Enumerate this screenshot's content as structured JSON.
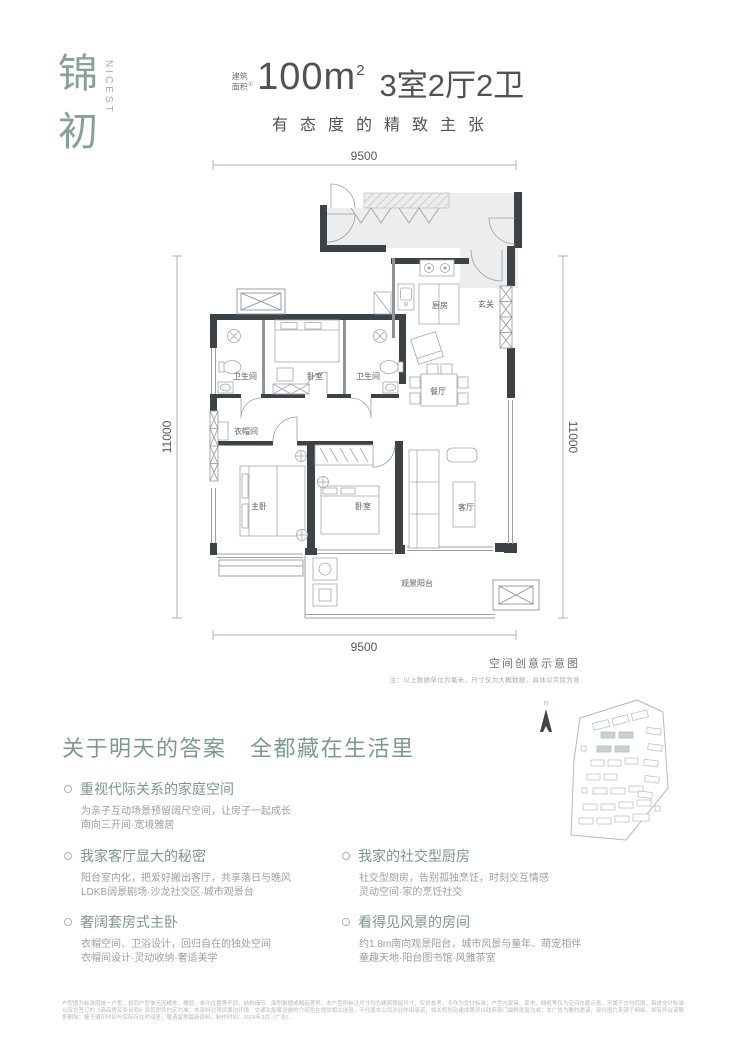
{
  "logo": {
    "char1": "锦",
    "char2": "初",
    "latin": "NICEST"
  },
  "header": {
    "area_label_top": "建筑",
    "area_label_bottom": "面积",
    "area_mark": "①",
    "area_value": "100m",
    "area_sup": "2",
    "layout_value": "3室2厅2卫",
    "slogan": "有态度的精致主张"
  },
  "floorplan": {
    "dims": {
      "top": "9500",
      "bottom": "9500",
      "left": "11000",
      "right": "11000"
    },
    "rooms": {
      "kitchen": "厨房",
      "entry": "玄关",
      "bathroom1": "卫生间",
      "bedroom_top": "卧室",
      "bathroom2": "卫生间",
      "dining": "餐厅",
      "cloakroom": "衣帽间",
      "master": "主卧",
      "bedroom2": "卧室",
      "living": "客厅",
      "balcony": "观景阳台"
    },
    "caption": "空间创意示意图",
    "note": "注：以上数据单位为毫米，尺寸仅为大概数据，具体以实际为准"
  },
  "sitemap": {
    "north_label": "N"
  },
  "section": {
    "heading": "关于明天的答案　全都藏在生活里",
    "features": [
      {
        "title": "重视代际关系的家庭空间",
        "line1": "为亲子互动场景预留阔尺空间，让房子一起成长",
        "line2": "南向三开间·宽境雅居"
      },
      {
        "title": "我家客厅显大的秘密",
        "line1": "阳台室内化，把爱好搬出客厅，共享落日与晚风",
        "line2": "LDKB阔景剧场·沙龙社交区·城市观景台"
      },
      {
        "title": "奢阔套房式主卧",
        "line1": "衣帽空间、卫浴设计，回归自在的独处空间",
        "line2": "衣帽间设计·灵动收纳·奢适美学"
      },
      {
        "title": "我家的社交型厨房",
        "line1": "社交型厨房，告别孤独烹饪，时刻交互情感",
        "line2": "灵动空间·家的烹饪社交"
      },
      {
        "title": "看得见风景的房间",
        "line1": "约1.8m南向观景阳台，城市风景与童年、萌宠相伴",
        "line2": "童趣天地·阳台图书馆·风雅茶室"
      }
    ]
  },
  "footer": {
    "disclaimer": "户型图为标准层统一户型，相同户型单元因楼栋、楼层、单元位置等不同，结构细节、面积数据或略有差异，本户型所标注尺寸均为建筑预留尺寸，仅供参考，不作为交付标准；户型内家具、家电、绿植等仅为空间布置示意，不属于交付范围，具体交付标准以双方签订的《商品房买卖合同》及其附件约定为准；本资料对项目周边环境、交通及配套设施的介绍旨在提供相关信息，不代表本公司对此作出承诺，相关规划及建成情况以政府部门最终批复为准；本广告为要约邀请，部分图片来源于网络，如有异议请联系删除；鉴于编印时间与实际存在时间差，敬请留意最新资料。制作时间：2024年3月（广告）。"
  }
}
